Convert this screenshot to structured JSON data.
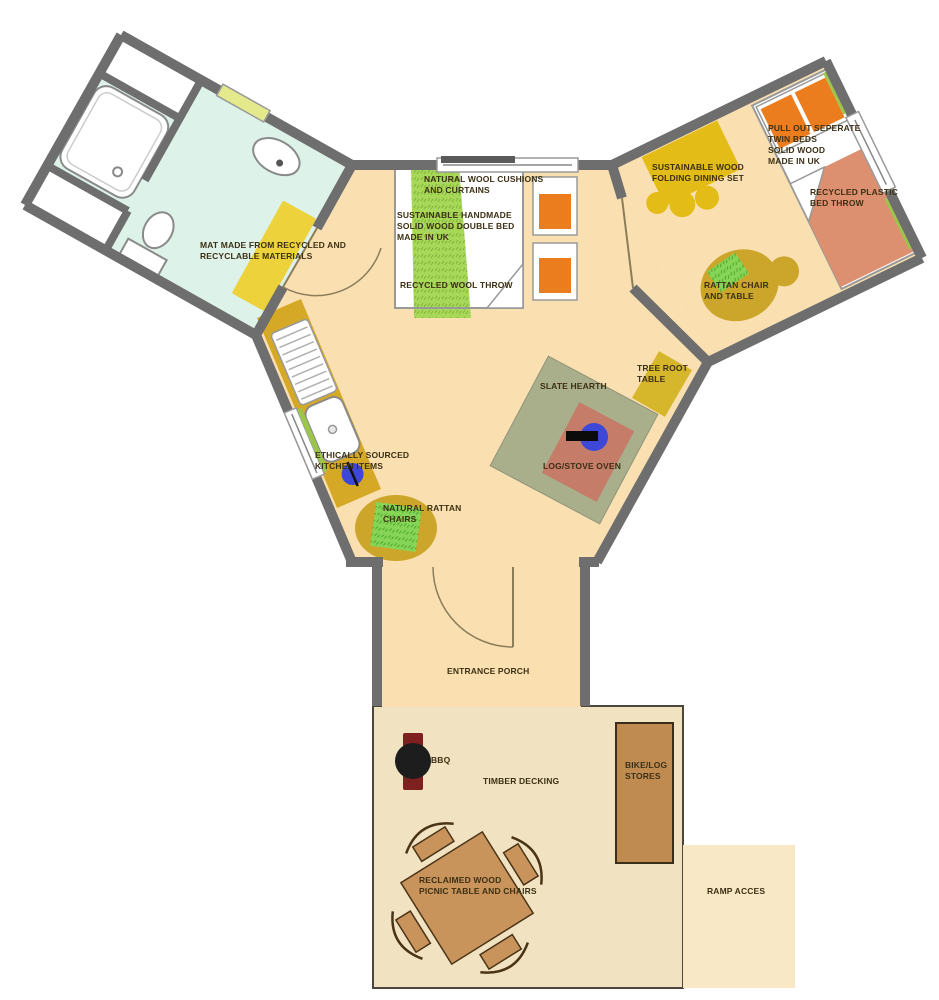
{
  "colors": {
    "wall": "#6E6E6E",
    "floor": "#FAE0B1",
    "bathroom_floor": "#DDF2E8",
    "deck": "#F1E2C1",
    "ramp": "#F9E8C5",
    "label_text": "#3C3014",
    "counter": "#D5A826",
    "mat_yellow": "#EDD23B",
    "window_green": "#E4EA8C",
    "hearth_green": "#A9AE8B",
    "oven_salmon": "#C57C69",
    "stove_blue": "#3D48D8",
    "throw_green": "#A8D858",
    "pillow_orange": "#EC7D1E",
    "twin_throw": "#DD9070",
    "dining_yellow": "#E3BC17",
    "rattan_gold": "#CBA62B",
    "rattan_green": "#86D556",
    "tree_table": "#D6B62B",
    "store_brown": "#C08B51",
    "picnic_brown": "#C9945B",
    "bbq_black": "#1D1D1D",
    "bbq_maroon": "#7E2020",
    "door_line": "#8B7D5A"
  },
  "areas": {
    "bathroom": {
      "mat_label": "MAT MADE FROM RECYCLED AND\nRECYCLABLE MATERIALS"
    },
    "double_bedroom": {
      "cushions_label": "NATURAL WOOL CUSHIONS\nAND CURTAINS",
      "bed_label": "SUSTAINABLE HANDMADE\nSOLID WOOD DOUBLE BED\nMADE IN UK",
      "throw_label": "RECYCLED WOOL THROW"
    },
    "twin_bedroom": {
      "dining_label": "SUSTAINABLE WOOD\nFOLDING DINING SET",
      "twin_beds_label": "PULL OUT SEPERATE\nTWIN BEDS\nSOLID WOOD\nMADE IN UK",
      "bed_throw_label": "RECYCLED PLASTIC\nBED THROW",
      "rattan_label": "RATTAN CHAIR\nAND TABLE"
    },
    "living_area": {
      "hearth_label": "SLATE HEARTH",
      "stove_label": "LOG/STOVE OVEN",
      "tree_table_label": "TREE ROOT\nTABLE",
      "kitchen_label": "ETHICALLY SOURCED\nKITCHEN ITEMS",
      "rattan_label": "NATURAL RATTAN\nCHAIRS"
    },
    "porch": {
      "label": "ENTRANCE PORCH"
    },
    "deck": {
      "label": "TIMBER DECKING",
      "bbq_label": "BBQ",
      "stores_label": "BIKE/LOG\nSTORES",
      "picnic_label": "RECLAIMED WOOD\nPICNIC TABLE AND CHAIRS",
      "ramp_label": "RAMP ACCES"
    }
  }
}
